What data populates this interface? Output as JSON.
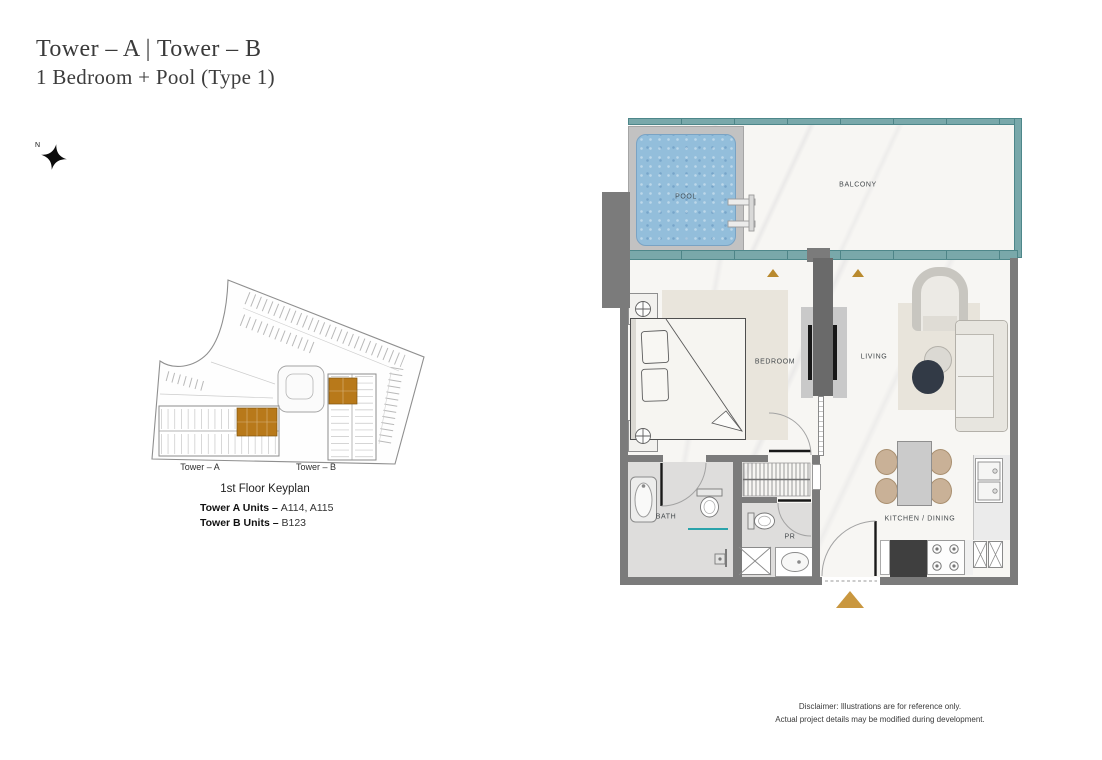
{
  "header": {
    "title": "Tower – A | Tower – B",
    "subtitle": "1 Bedroom + Pool (Type 1)"
  },
  "north": {
    "label": "N"
  },
  "keyplan": {
    "tower_a_label": "Tower – A",
    "tower_b_label": "Tower – B",
    "caption": "1st Floor Keyplan",
    "units": [
      {
        "label": "Tower A Units – ",
        "value": "A114, A115"
      },
      {
        "label": "Tower B Units – ",
        "value": "B123"
      }
    ],
    "highlight_color": "#b8791a"
  },
  "floorplan": {
    "labels": {
      "pool": "POOL",
      "balcony": "BALCONY",
      "bedroom": "BEDROOM",
      "living": "LIVING",
      "bath": "BATH",
      "pr": "PR",
      "kitchen": "KITCHEN / DINING"
    },
    "colors": {
      "wall": "#7b7b7b",
      "railing_teal": "#79a8aa",
      "railing_teal_dark": "#4d8487",
      "pool_water": "#93bedb",
      "pool_deck": "#c2c2c2",
      "entry_triangle": "#c9973f",
      "door_marker": "#b98a2e",
      "keyplan_highlight": "#b8791a"
    }
  },
  "disclaimer": {
    "line1": "Disclaimer: Illustrations are for reference only.",
    "line2": "Actual project details may be modified during development."
  }
}
